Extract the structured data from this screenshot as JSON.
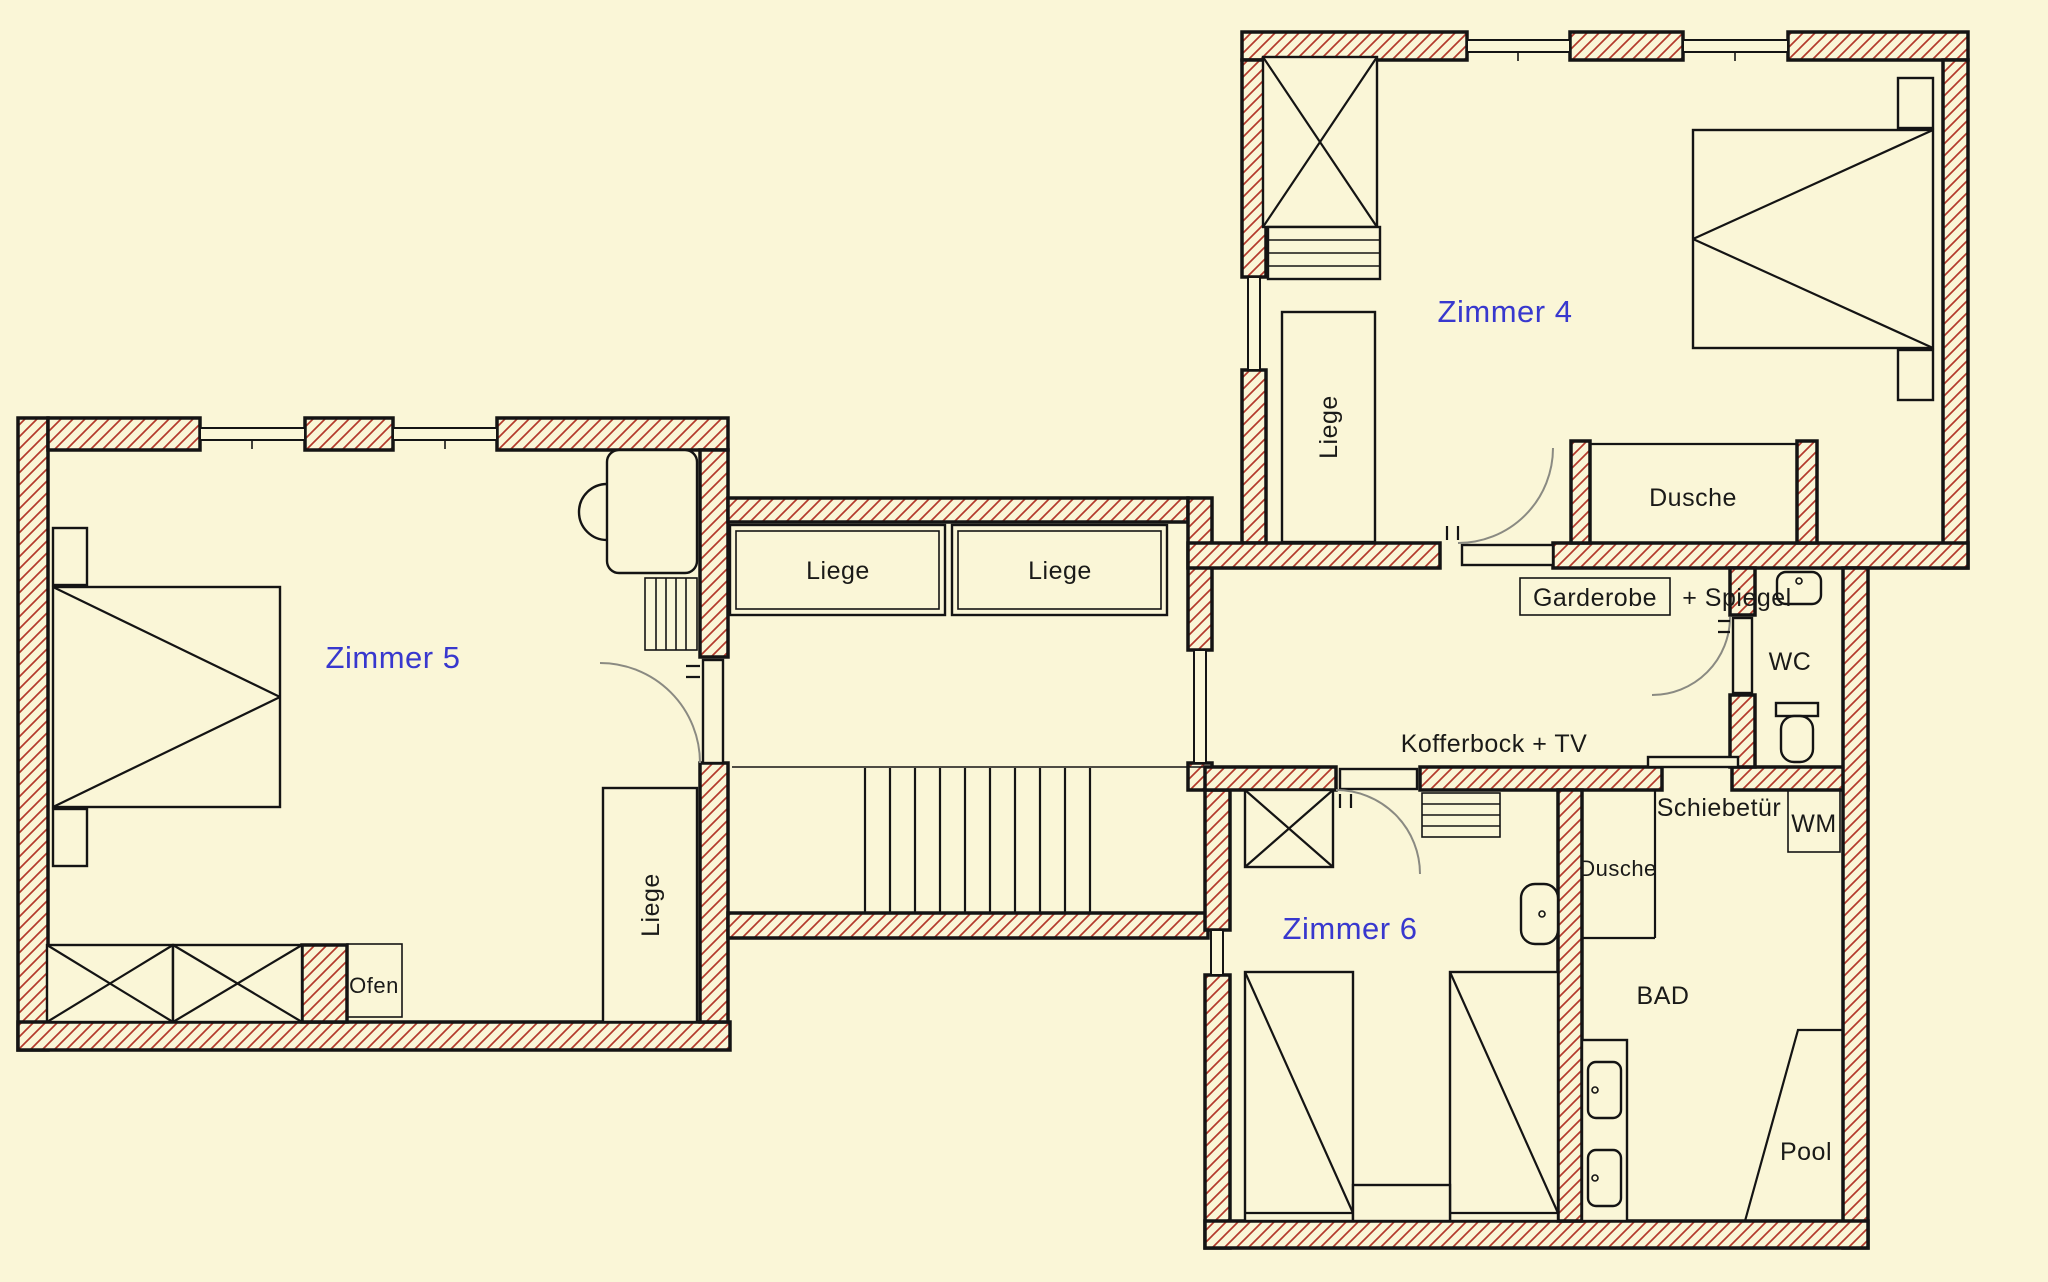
{
  "title": "Floor plan upper level - Zimmer 4, 5, 6",
  "labels": {
    "zimmer4": "Zimmer 4",
    "zimmer5": "Zimmer 5",
    "zimmer6": "Zimmer 6",
    "liege": "Liege",
    "dusche": "Dusche",
    "garderobe": "Garderobe",
    "spiegel_suffix": "+ Spiegel",
    "kofferbock_tv": "Kofferbock + TV",
    "schiebetuer": "Schiebetür",
    "wc": "WC",
    "wm": "WM",
    "bad": "BAD",
    "pool": "Pool",
    "ofen": "Ofen"
  },
  "colors": {
    "background": "#FAF6D7",
    "wall_hatch": "#B43A2C",
    "line": "#141414",
    "room_label": "#3838CE",
    "door_arc": "#8a8a82"
  }
}
